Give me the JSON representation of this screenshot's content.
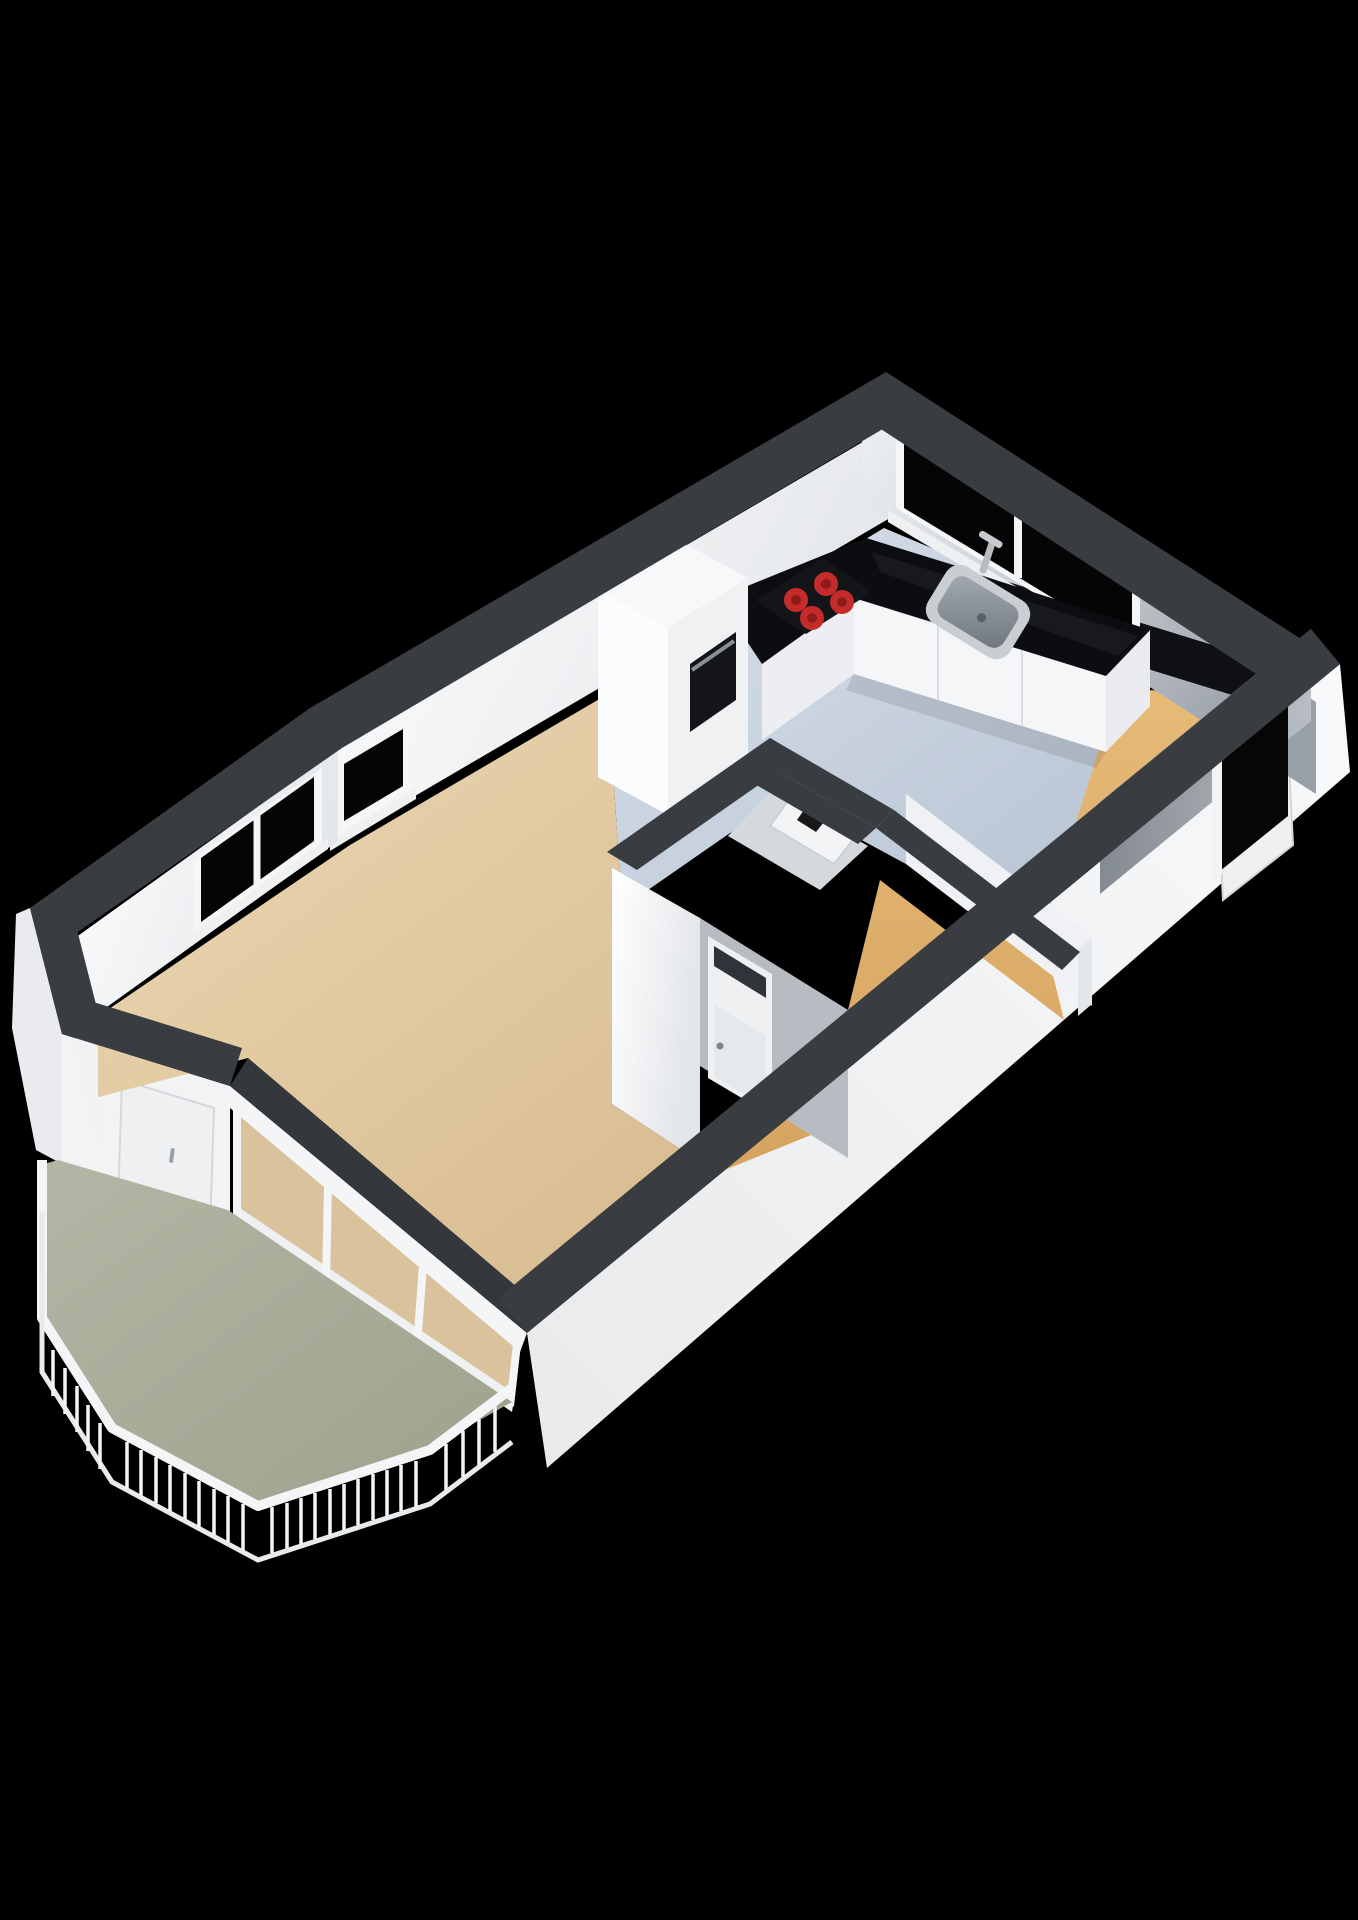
{
  "scene": {
    "type": "3d-floor-plan-render",
    "view": "isometric perspective, viewed from above",
    "background": "#000000",
    "text_visible_in_image": "none"
  },
  "colors": {
    "background": "#000000",
    "wall_cap": "#393c40",
    "wall_cap_dark": "#34373b",
    "interior_wall_white": "#f7f8fa",
    "interior_wall_light": "#eff1f4",
    "exterior_wall": "#f2f3f5",
    "exterior_wall_dim": "#e9ebee",
    "gray_wall": "#b7bcc2",
    "kitchen_floor": "#c5cfdc",
    "living_floor": "#e0c8a2",
    "hall_floor": "#dfb271",
    "balcony_floor": "#a9ad9b",
    "closet_floor": "#d5d9dd",
    "counter_top_black": "#0c0d10",
    "counter_gloss": "#22242a",
    "cabinet_front": "#f5f6f8",
    "cabinet_front_dim": "#eceef1",
    "window_glass": "#050506",
    "backsplash_black": "#101114",
    "cooktop_black": "#141519",
    "burner_red": "#c62b2b",
    "burner_red_dark": "#8e1c1c",
    "oven_black": "#141518",
    "oven_handle": "#8a9096",
    "sink_rim": "#c9ced3",
    "sink_basin": "#8d949b",
    "door_white": "#eef0f2",
    "door_frame": "#f1f3f5",
    "door_handle": "#9aa0a6",
    "transom_glass": "#30343a",
    "glass_reflection_tan": "#d9c29c",
    "railing_white": "#f3f5f6",
    "utility_red": "#c23434",
    "utility_black": "#17181a",
    "doorway_opening": "#060607"
  },
  "rooms": [
    {
      "id": "kitchen",
      "position": "top-right",
      "floor": "light blue-gray",
      "fixtures": [
        "L-shaped black countertop",
        "ceramic cooktop with 4 red burners",
        "inset sink with faucet under window",
        "tall cabinet column with built-in oven",
        "large two-sash window on top-right wall"
      ]
    },
    {
      "id": "living-room",
      "position": "center-left",
      "floor": "tan",
      "fixtures": [
        "single window on upper-left wall",
        "double window on angled bay wall",
        "floor-to-ceiling glass wall to balcony"
      ]
    },
    {
      "id": "hallway",
      "position": "lower-right strip",
      "floor": "orange-tan",
      "fixtures": [
        "entrance doorway opening in lower-right wall with white frame",
        "entrance door leaf with handle seen on exterior"
      ]
    },
    {
      "id": "bathroom-block",
      "position": "center",
      "floor": "hidden",
      "fixtures": [
        "door with transom glass panel and handle",
        "gray side walls"
      ]
    },
    {
      "id": "utility-closet",
      "position": "center, beside bathroom",
      "floor": "light gray",
      "fixtures": [
        "white utility/meter box with red and black items"
      ]
    },
    {
      "id": "balcony",
      "position": "bottom-left",
      "floor": "sage green",
      "fixtures": [
        "white picket railing around octagonal edge",
        "balcony access door with handle",
        "three-panel glass sliding wall"
      ]
    }
  ],
  "counts": {
    "windows": 4,
    "doors": 4,
    "cooktop_burners": 4,
    "glass_wall_panels": 3,
    "railing_segments": 6
  }
}
